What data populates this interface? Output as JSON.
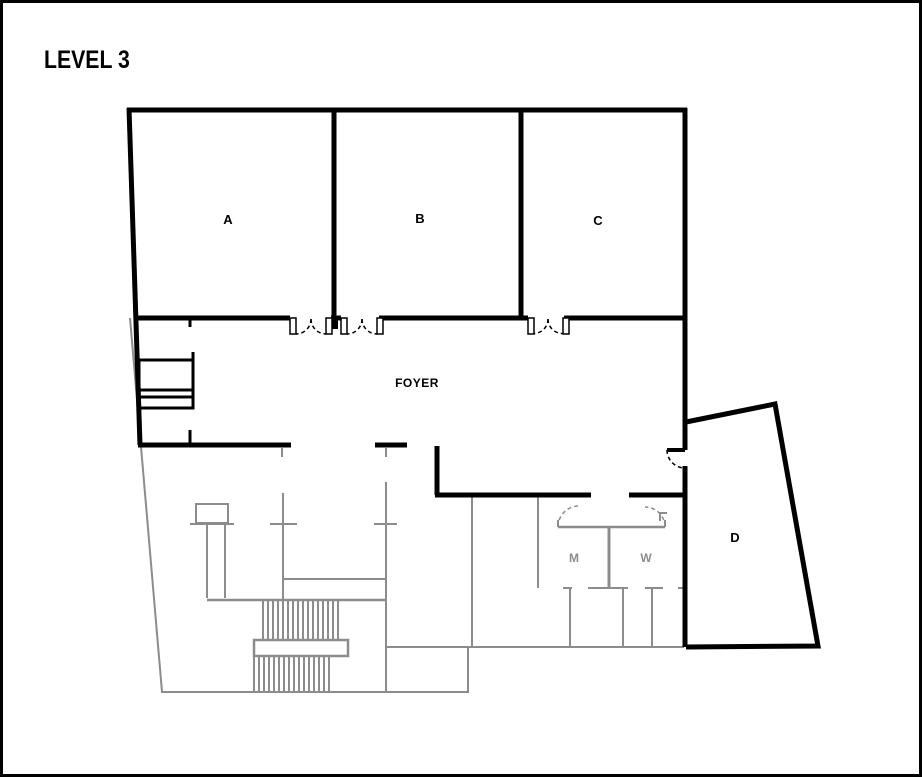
{
  "title": "LEVEL 3",
  "colors": {
    "wall": "#000000",
    "below_level": "#8c8c8c",
    "background": "#ffffff"
  },
  "labels": {
    "room_a": "A",
    "room_b": "B",
    "room_c": "C",
    "room_d": "D",
    "foyer": "FOYER",
    "mens_room": "M",
    "womens_room": "W"
  }
}
